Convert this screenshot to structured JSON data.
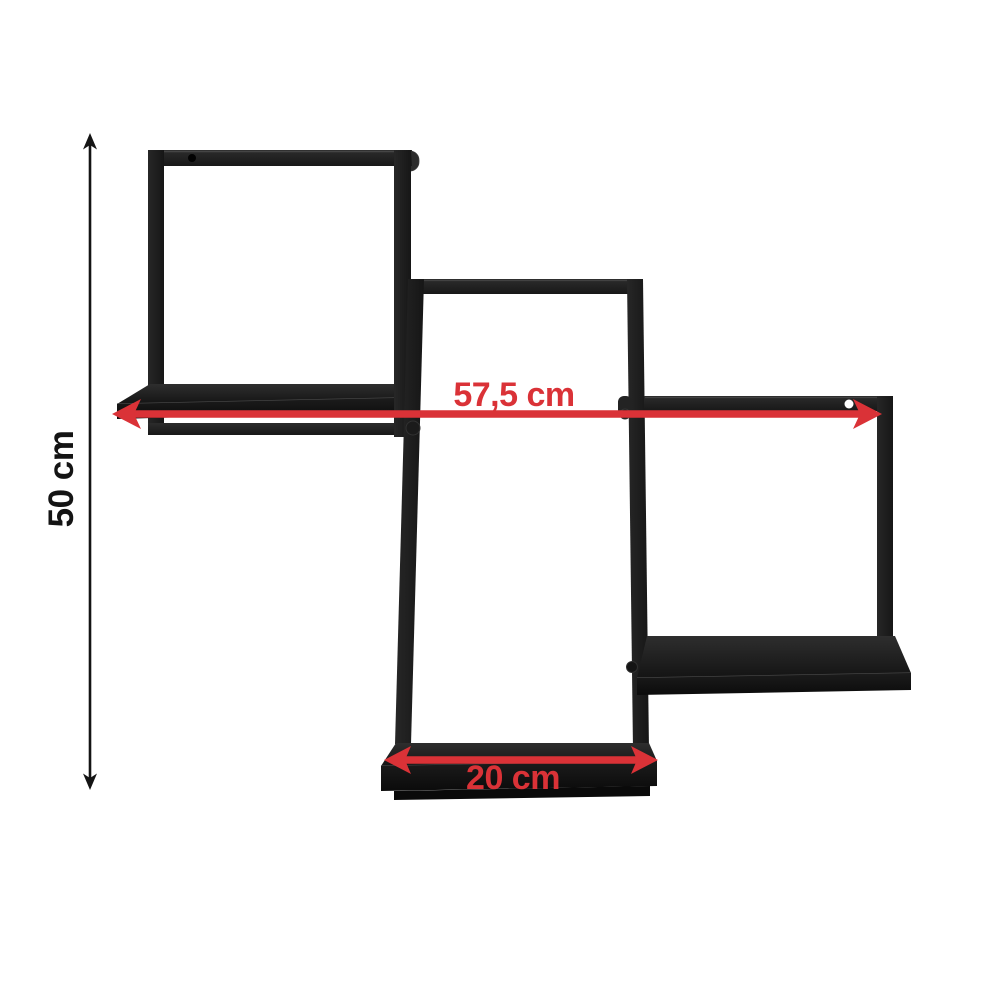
{
  "image": {
    "background": "#ffffff",
    "caption": "Black metal wall shelf with three staggered square frames, two mounting holes and red dimension arrows"
  },
  "product": {
    "name": "wall shelf",
    "frame_color": "#1f1f1f"
  },
  "colors": {
    "dimension_red": "#da3237",
    "dimension_black": "#141414",
    "mounting_hole_left": "#020202",
    "mounting_hole_right": "#ffffff"
  },
  "dimensions": {
    "height": {
      "label": "50 cm"
    },
    "width": {
      "label": "57,5 cm"
    },
    "depth": {
      "label": "20 cm"
    }
  }
}
